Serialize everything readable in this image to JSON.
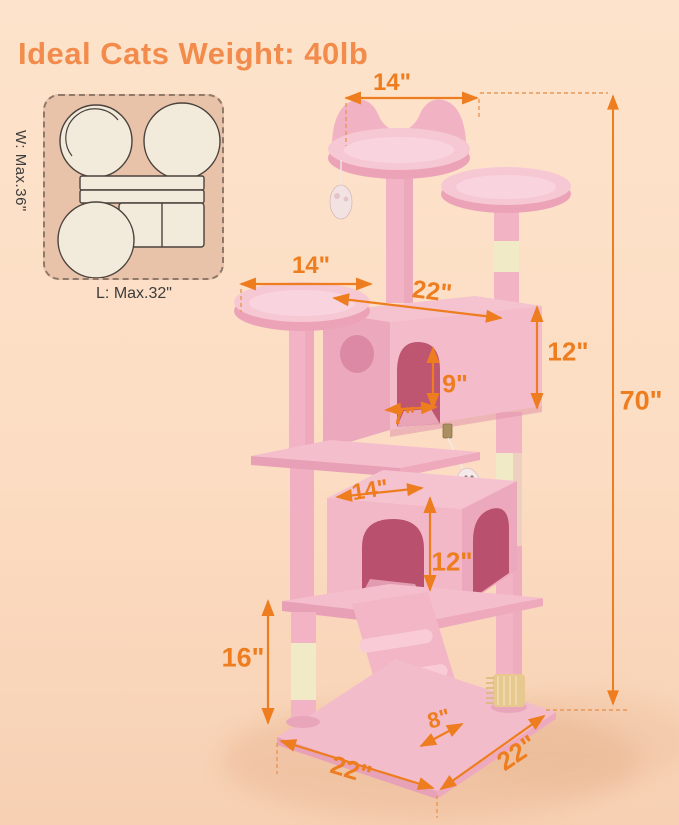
{
  "title": "Ideal Cats Weight: 40lb",
  "footprint": {
    "width_label": "W: Max.36\"",
    "length_label": "L: Max.32\""
  },
  "dims": {
    "top_perch_width": "14\"",
    "left_platform_width": "14\"",
    "condo_width": "22\"",
    "condo_height": "12\"",
    "door_height": "9\"",
    "door_width": "7\"",
    "lower_condo_width": "14\"",
    "lower_condo_height": "12\"",
    "bottom_section_height": "16\"",
    "ramp_width": "8\"",
    "base_depth": "22\"",
    "base_width": "22\"",
    "total_height": "70\""
  },
  "colors": {
    "background": "#FCDDC3",
    "title_orange": "#F28B4B",
    "dimension_orange": "#EE7D1F",
    "tree_pink": "#F3B9C8",
    "sisal_cream": "#F1EAC6",
    "footprint_tan": "#E9C2AA"
  }
}
